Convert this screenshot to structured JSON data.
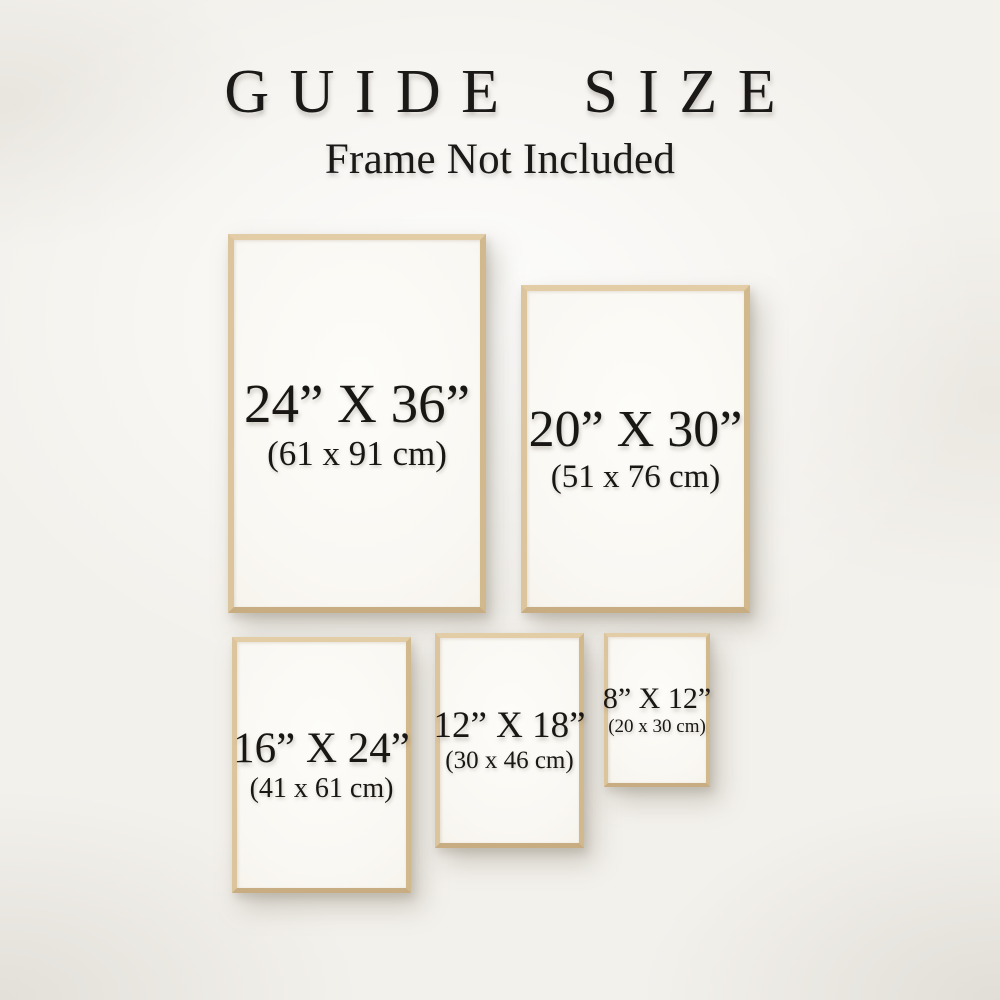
{
  "header": {
    "title": "GUIDE SIZE",
    "subtitle": "Frame Not Included"
  },
  "colors": {
    "wall_background": "#f3f1ec",
    "frame_wood": "#d8bd95",
    "poster_white": "#fcfbf8",
    "text": "#191714"
  },
  "frames": [
    {
      "id": "24x36",
      "size_in": "24” X 36”",
      "size_cm": "(61 x 91 cm)"
    },
    {
      "id": "20x30",
      "size_in": "20” X 30”",
      "size_cm": "(51 x 76 cm)"
    },
    {
      "id": "16x24",
      "size_in": "16” X 24”",
      "size_cm": "(41 x 61 cm)"
    },
    {
      "id": "12x18",
      "size_in": "12” X 18”",
      "size_cm": "(30 x 46 cm)"
    },
    {
      "id": "8x12",
      "size_in": "8” X 12”",
      "size_cm": "(20 x 30 cm)"
    }
  ]
}
